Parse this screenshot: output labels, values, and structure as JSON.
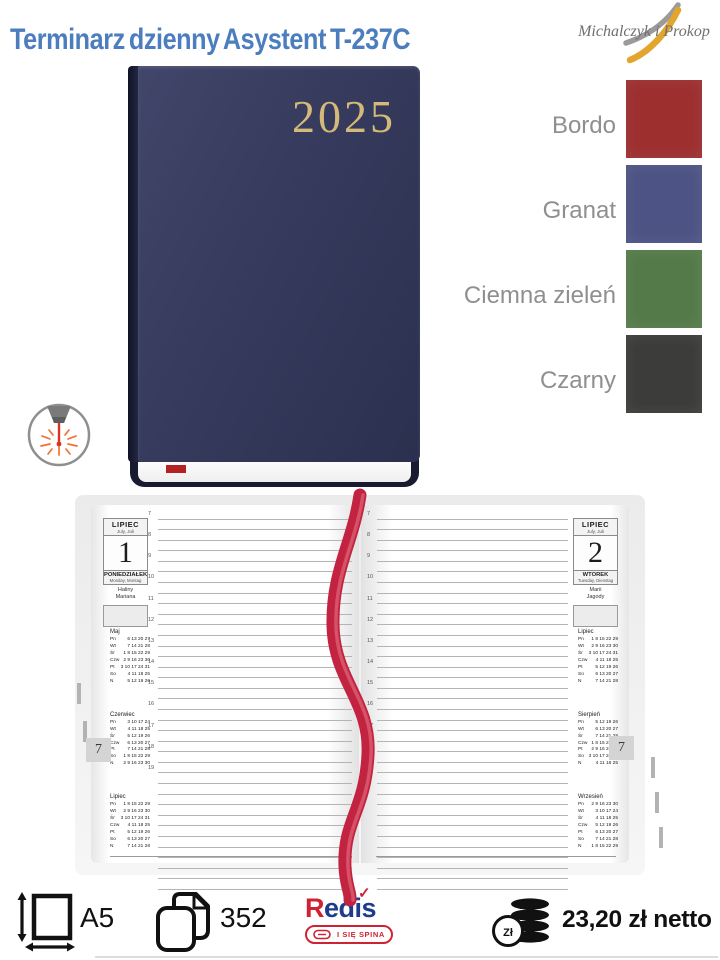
{
  "header": {
    "title": "Terminarz dzienny Asystent T-237C",
    "brand": "Michalczyk i Prokop"
  },
  "book": {
    "year": "2025"
  },
  "color_options": [
    {
      "label": "Bordo",
      "hex": "#9d2f2f"
    },
    {
      "label": "Granat",
      "hex": "#4d5384"
    },
    {
      "label": "Ciemna zieleń",
      "hex": "#557a49"
    },
    {
      "label": "Czarny",
      "hex": "#3c3c3a"
    }
  ],
  "spread": {
    "left": {
      "month": "LIPIEC",
      "month_sub": "July, Juli",
      "day": "1",
      "weekday": "PONIEDZIAŁEK",
      "weekday_sub": "Monday, Montag",
      "nameday1": "Haliny",
      "nameday2": "Mariana",
      "tab": "7",
      "hours": [
        "7",
        "8",
        "9",
        "10",
        "11",
        "12",
        "13",
        "14",
        "15",
        "16",
        "17",
        "18",
        "19"
      ],
      "extra_lines": 11,
      "calendars": [
        {
          "title": "Maj",
          "rows": [
            [
              "Pn",
              "6 13 20 27"
            ],
            [
              "Wt",
              "7 14 21 28"
            ],
            [
              "Śr",
              "1 8 15 22 29"
            ],
            [
              "Czw",
              "2 9 16 23 30"
            ],
            [
              "Pt",
              "3 10 17 24 31"
            ],
            [
              "So",
              "4 11 18 25"
            ],
            [
              "N",
              "5 12 19 26"
            ]
          ]
        },
        {
          "title": "Czerwiec",
          "rows": [
            [
              "Pn",
              "3 10 17 24"
            ],
            [
              "Wt",
              "4 11 18 25"
            ],
            [
              "Śr",
              "5 12 19 26"
            ],
            [
              "Czw",
              "6 13 20 27"
            ],
            [
              "Pt",
              "7 14 21 28"
            ],
            [
              "So",
              "1 8 15 22 29"
            ],
            [
              "N",
              "2 9 16 23 30"
            ]
          ]
        },
        {
          "title": "Lipiec",
          "rows": [
            [
              "Pn",
              "1 8 15 22 29"
            ],
            [
              "Wt",
              "2 9 16 23 30"
            ],
            [
              "Śr",
              "3 10 17 24 31"
            ],
            [
              "Czw",
              "4 11 18 25"
            ],
            [
              "Pt",
              "5 12 19 26"
            ],
            [
              "So",
              "6 13 20 27"
            ],
            [
              "N",
              "7 14 21 28"
            ]
          ]
        }
      ]
    },
    "right": {
      "month": "LIPIEC",
      "month_sub": "July, Juli",
      "day": "2",
      "weekday": "WTOREK",
      "weekday_sub": "Tuesday, Dienstag",
      "nameday1": "Marii",
      "nameday2": "Jagody",
      "tab": "7",
      "hours": [
        "7",
        "8",
        "9",
        "10",
        "11",
        "12",
        "13",
        "14",
        "15",
        "16",
        "17",
        "18",
        "19"
      ],
      "extra_lines": 11,
      "calendars": [
        {
          "title": "Lipiec",
          "rows": [
            [
              "Pn",
              "1 8 15 22 29"
            ],
            [
              "Wt",
              "2 9 16 23 30"
            ],
            [
              "Śr",
              "3 10 17 24 31"
            ],
            [
              "Czw",
              "4 11 18 25"
            ],
            [
              "Pt",
              "5 12 19 26"
            ],
            [
              "So",
              "6 13 20 27"
            ],
            [
              "N",
              "7 14 21 28"
            ]
          ]
        },
        {
          "title": "Sierpień",
          "rows": [
            [
              "Pn",
              "5 12 19 26"
            ],
            [
              "Wt",
              "6 13 20 27"
            ],
            [
              "Śr",
              "7 14 21 28"
            ],
            [
              "Czw",
              "1 8 15 22 29"
            ],
            [
              "Pt",
              "2 9 16 23 30"
            ],
            [
              "So",
              "3 10 17 24 31"
            ],
            [
              "N",
              "4 11 18 25"
            ]
          ]
        },
        {
          "title": "Wrzesień",
          "rows": [
            [
              "Pn",
              "2 9 16 23 30"
            ],
            [
              "Wt",
              "3 10 17 24"
            ],
            [
              "Śr",
              "4 11 18 25"
            ],
            [
              "Czw",
              "5 12 19 26"
            ],
            [
              "Pt",
              "6 13 20 27"
            ],
            [
              "So",
              "7 14 21 28"
            ],
            [
              "N",
              "1 8 15 22 29"
            ]
          ]
        }
      ]
    }
  },
  "specs": {
    "format": "A5",
    "pages": "352",
    "price": "23,20 zł netto",
    "currency_coin": "Zł"
  },
  "redis": {
    "name_first_letter": "R",
    "name_rest": "edis",
    "tagline": "I SIĘ SPINA"
  }
}
